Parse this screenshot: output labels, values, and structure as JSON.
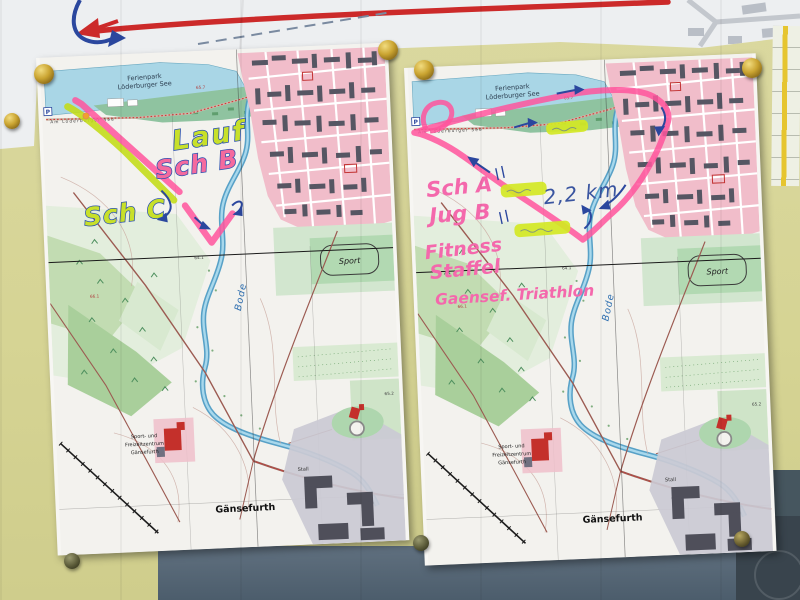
{
  "map_labels": {
    "ferienpark_line1": "Ferienpark",
    "ferienpark_line2": "Löderburger See",
    "street": "Am Löderburger See",
    "parking": "P",
    "river": "Bode",
    "sport": "Sport",
    "sfz_line1": "Sport- und",
    "sfz_line2": "Freizeitzentrum",
    "sfz_line3": "Gänsefurth",
    "town": "Gänsefurth",
    "stall": "Stall",
    "elev_657": "65.7",
    "elev_661": "66.1",
    "elev_641": "64.1",
    "elev_652": "65.2"
  },
  "left_map": {
    "lauf": "Lauf",
    "schb": "Sch B",
    "schc": "Sch C"
  },
  "right_map": {
    "sch_a": "Sch A",
    "jug_b": "Jug B",
    "fitness": "Fitness",
    "staffel": "Staffel",
    "gaensef": "Gaensef. Triathlon",
    "distance": "2,2 km"
  },
  "colors": {
    "highlight_pink": "#ff559c",
    "highlight_green": "#c8e02a",
    "pen_blue": "#2b479e",
    "pen_pink": "#f468ac",
    "wall": "#d6d494",
    "board": "#56687a",
    "lake": "#a9d6e6",
    "town_pink": "#f1bdca",
    "pin_brass": "#caa431"
  }
}
